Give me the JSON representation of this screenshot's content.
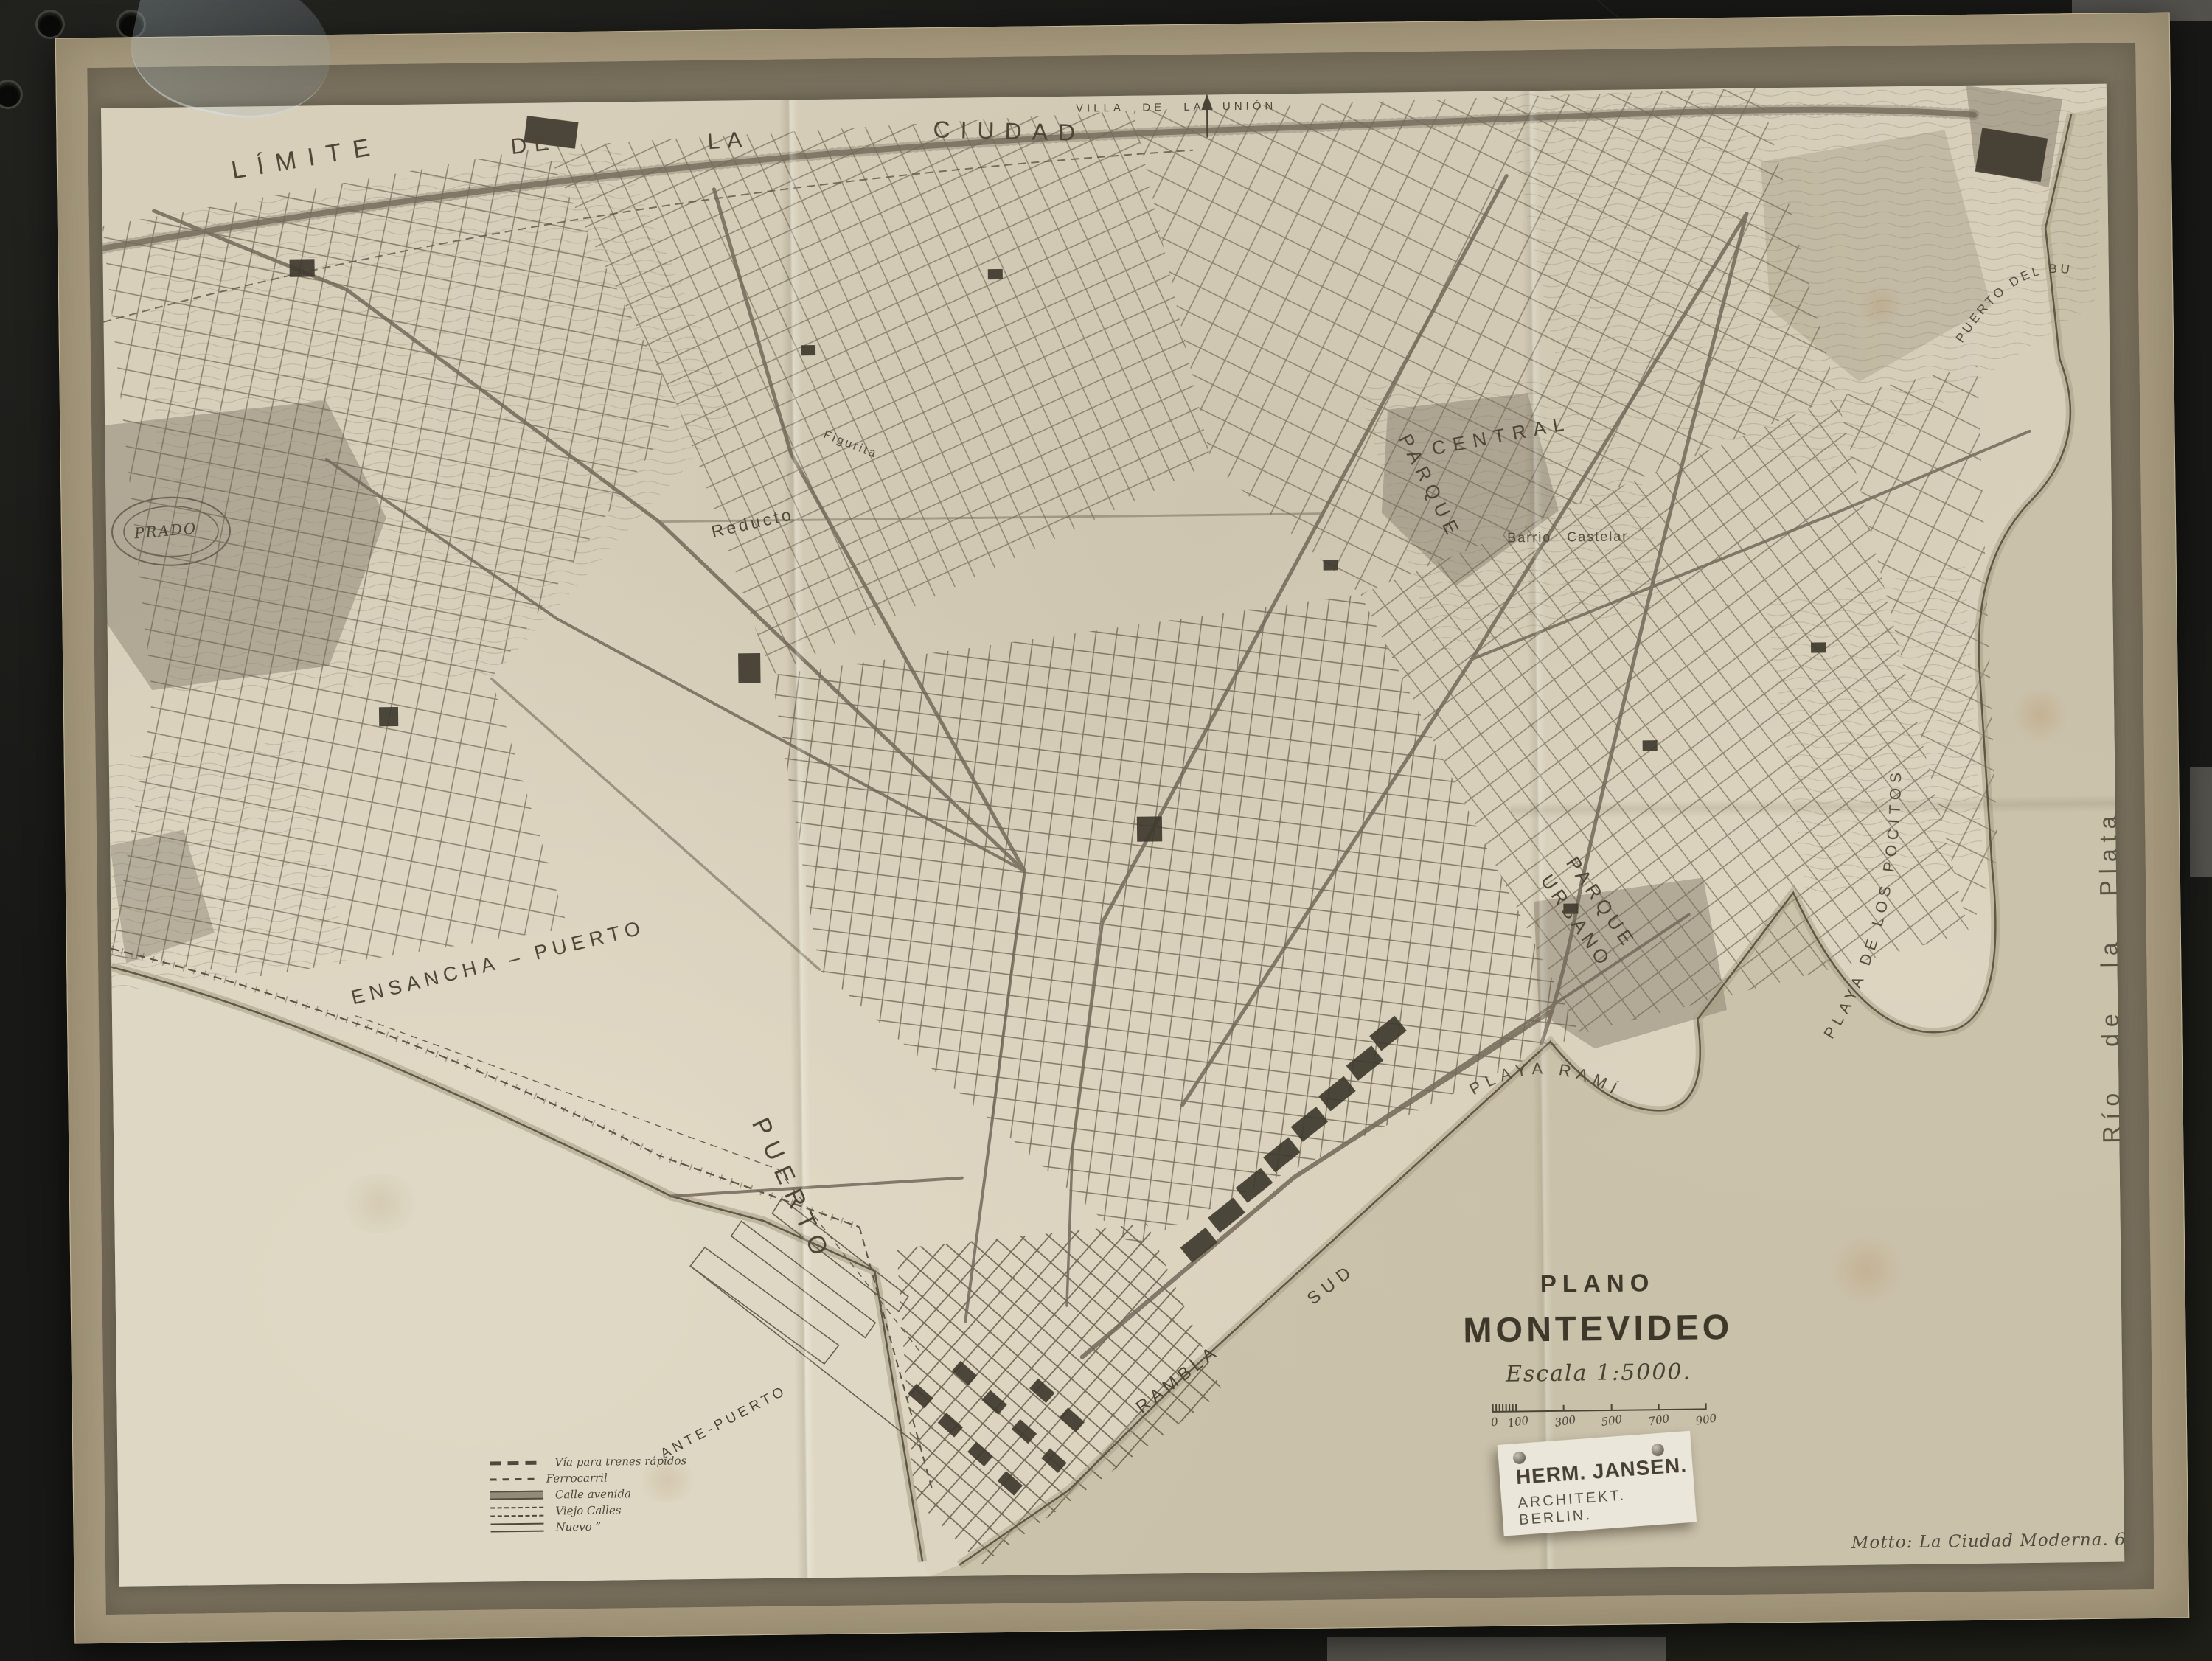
{
  "title_block": {
    "kicker": "PLANO",
    "title": "MONTEVIDEO",
    "scale_label": "Escala 1:5000.",
    "scale_ticks": [
      "0",
      "100",
      "300",
      "500",
      "700",
      "900"
    ]
  },
  "credit_card": {
    "name": "HERM. JANSEN.",
    "role": "ARCHITEKT. BERLIN."
  },
  "motto": "Motto:  La Ciudad Moderna. 6",
  "legend": {
    "items": [
      {
        "label": "Vía para trenes rápidos"
      },
      {
        "label": "Ferrocarril"
      },
      {
        "label": "Calle avenida"
      },
      {
        "label": "Viejo Calles"
      },
      {
        "label": "Nuevo  ”"
      }
    ]
  },
  "map_labels": {
    "limite": [
      "LÍMITE",
      "DE",
      "LA",
      "CIUDAD"
    ],
    "villa_union": "VILLA DE LA UNIÓN",
    "prado": "PRADO",
    "reducto": "Reducto",
    "figurita": "Figurita",
    "parque_word": "PARQUE",
    "central_word": "CENTRAL",
    "barrio_castelar": "Barrio Castelar",
    "parque_urbano": "PARQUE URBANO",
    "playa_ramirez": "PLAYA RAMÍREZ",
    "playa_pocitos": "PLAYA DE LOS POCITOS",
    "puerto_buceo": "PUERTO DEL BUCEO",
    "rio_plata": "Río de la Plata",
    "ensancha_puerto": "ENSANCHA – PUERTO",
    "puerto": "PUERTO",
    "ante_puerto": "ANTE-PUERTO",
    "rambla": "RAMBLA",
    "sud": "SUD"
  },
  "colors": {
    "background": "#191917",
    "sheet_rim": "#a79a7f",
    "sheet_band": "#79705d",
    "paper": "#d7cfba",
    "ink": "#4a4336",
    "water": "#c6bda6",
    "card": "#eae6d9"
  }
}
